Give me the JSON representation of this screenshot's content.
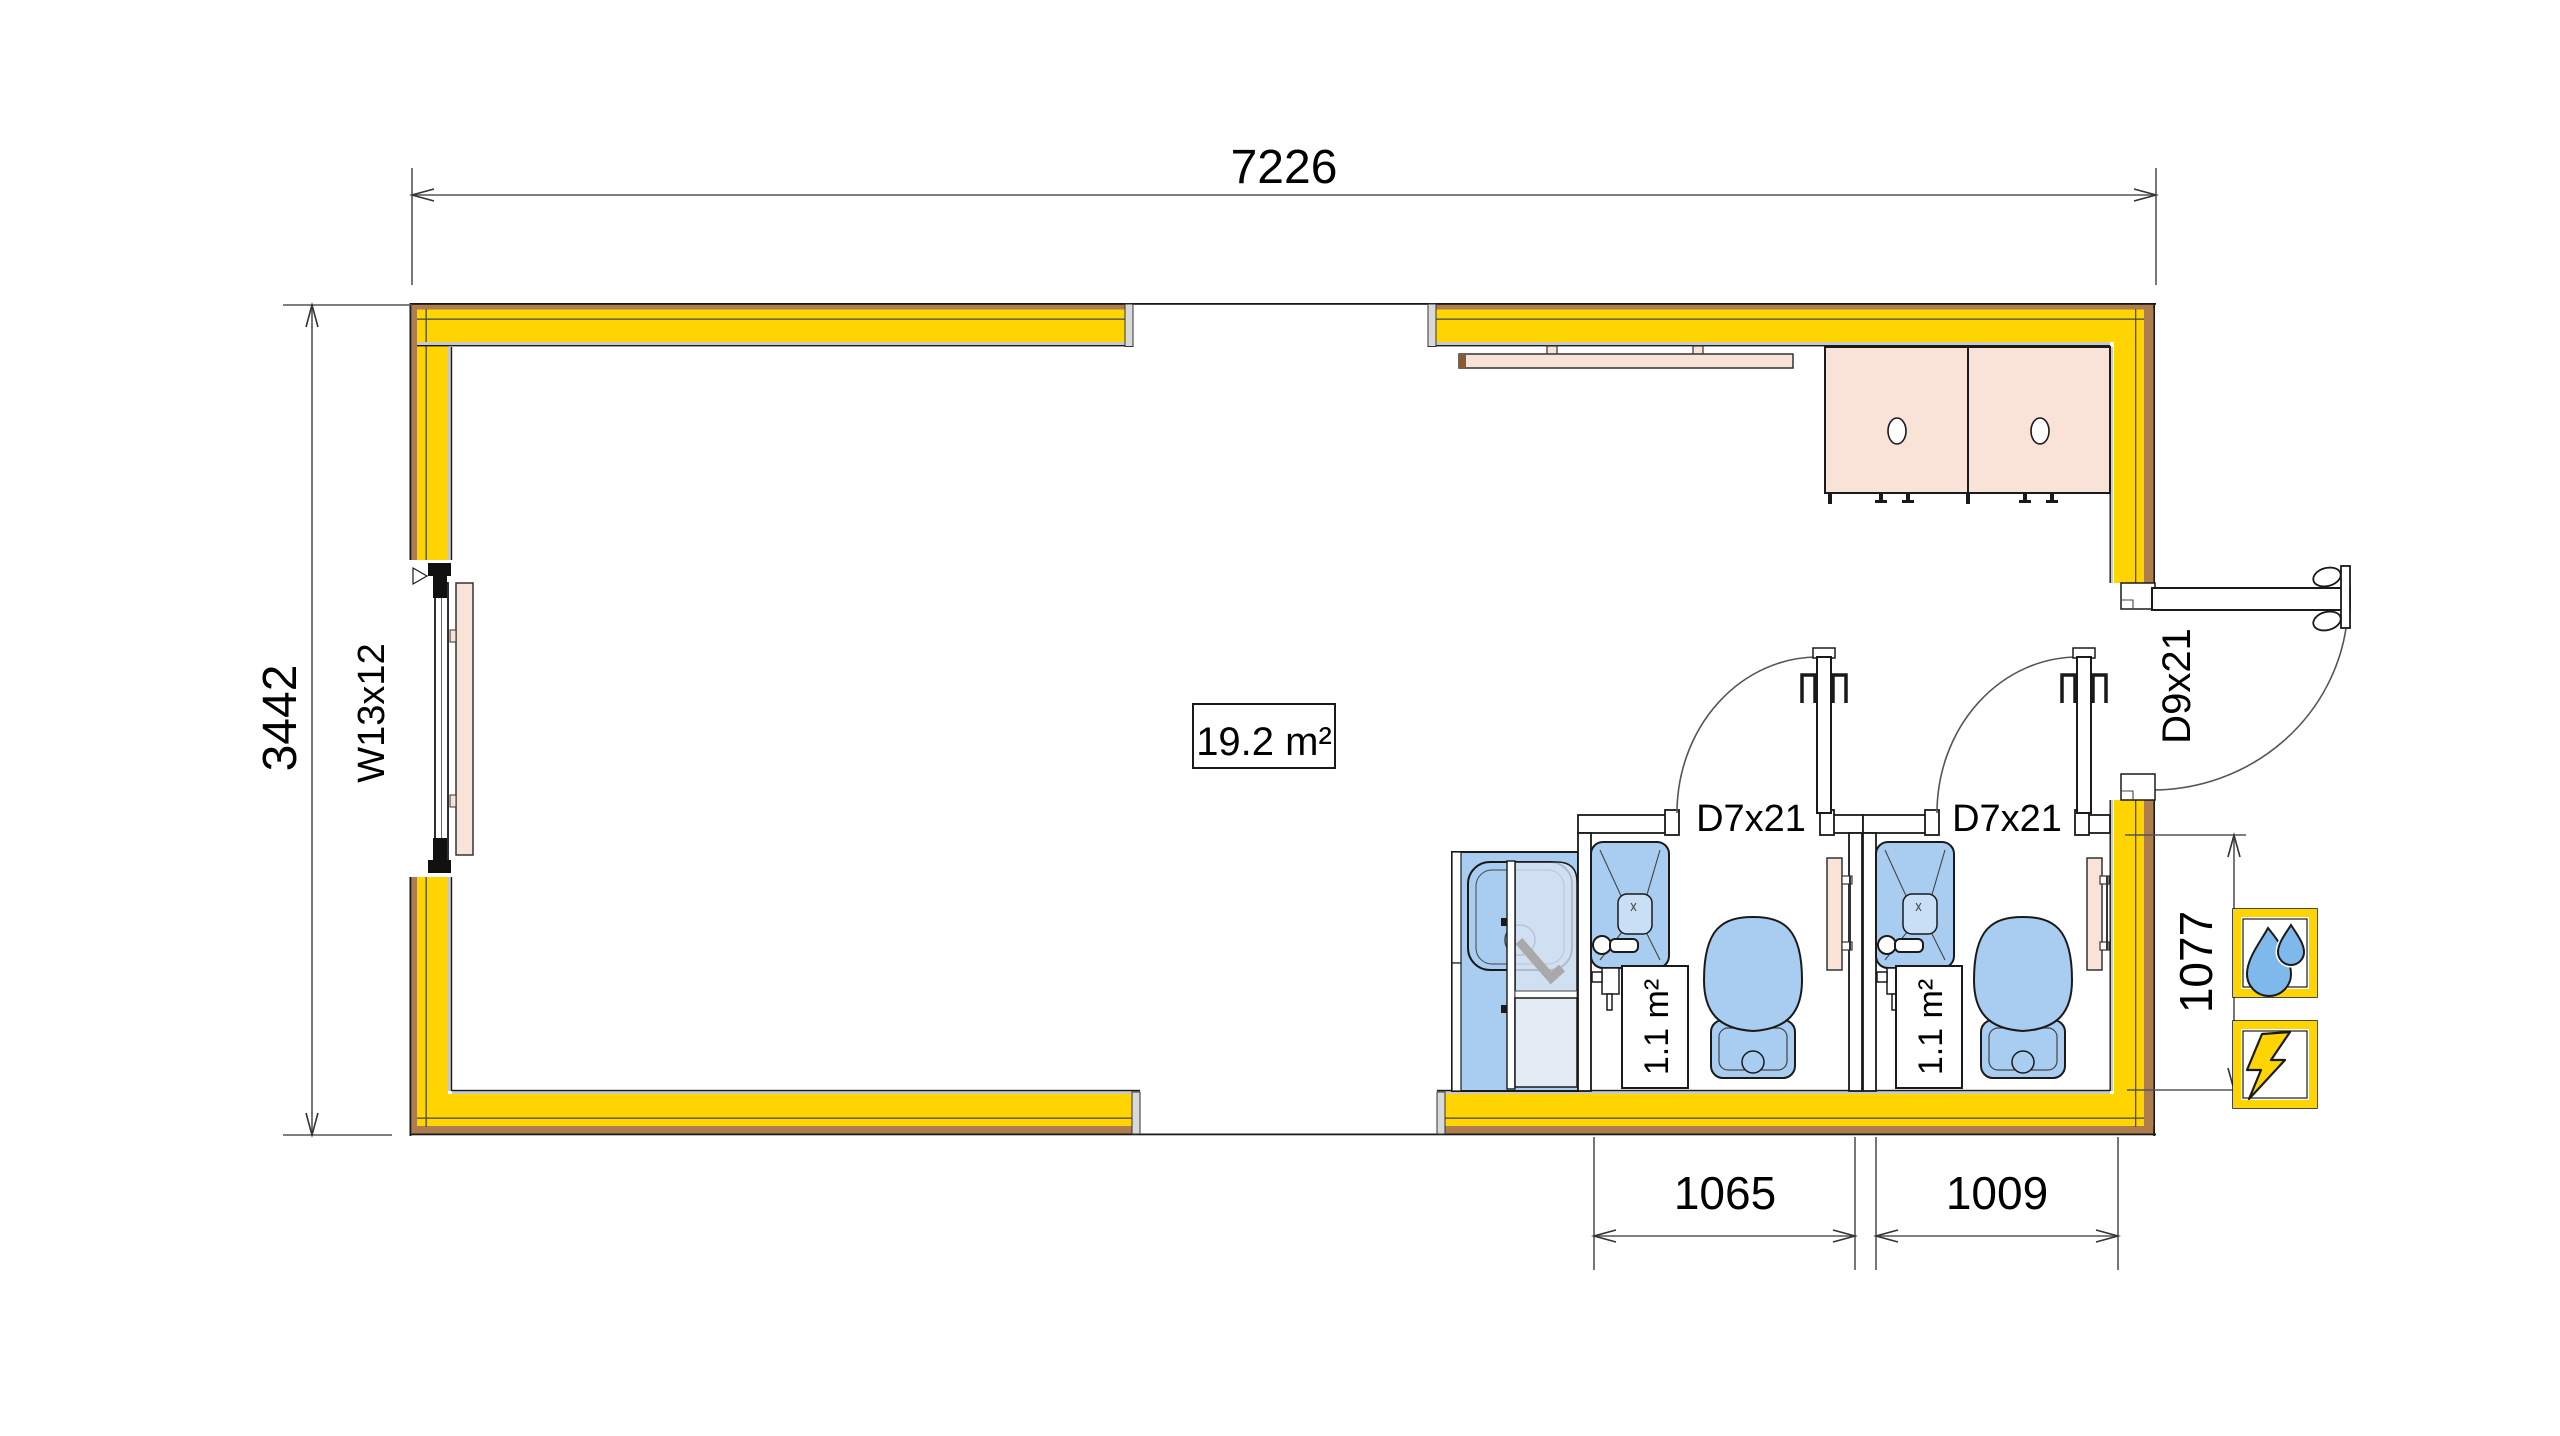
{
  "plan": {
    "dims": {
      "width": "7226",
      "depth": "3442",
      "recess": "1077",
      "wc1": "1065",
      "wc2": "1009"
    },
    "labels": {
      "window": "W13x12",
      "main_area": "19.2 m²",
      "wc1_area": "1.1 m²",
      "wc2_area": "1.1 m²",
      "wc1_door": "D7x21",
      "wc2_door": "D7x21",
      "entry_door": "D9x21"
    },
    "icons": {
      "water": "water-drops-icon",
      "power": "lightning-bolt-icon"
    },
    "colors": {
      "wall_yellow": "#FFD400",
      "cladding_brown": "#AD7D4E",
      "fixture_blue": "#A8CDF0",
      "fixture_blue_light": "#C9DFF6",
      "glass_blue": "#D9E4F2",
      "glass_blue_pale": "#E4EBF5",
      "wood_pink": "#F9E2D7",
      "icon_blue": "#7FB9EB",
      "line_gray": "#555555"
    }
  }
}
